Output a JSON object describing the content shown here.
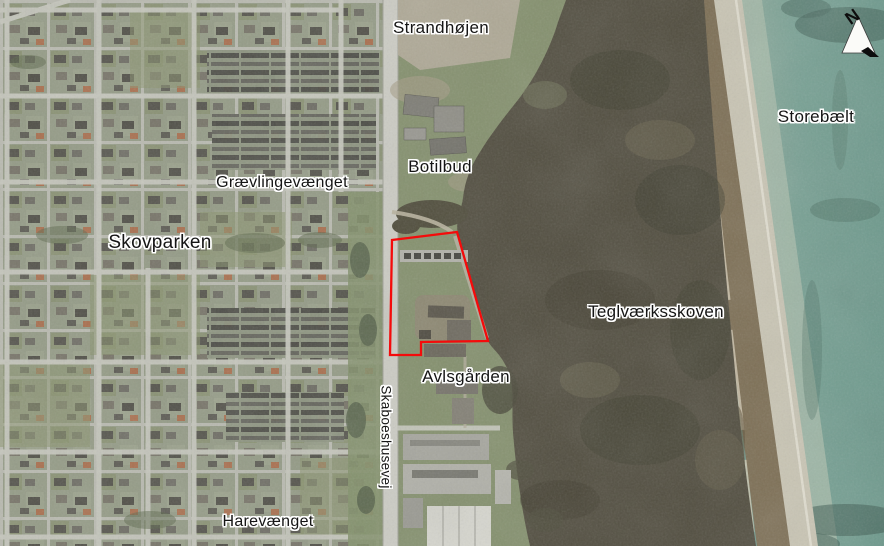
{
  "map": {
    "kind": "aerial-photo-map",
    "labels": {
      "strandhojen": "Strandhøjen",
      "storebaelt": "Storebælt",
      "botilbud": "Botilbud",
      "graevlingevaenget": "Grævlingevænget",
      "skovparken": "Skovparken",
      "teglvaerksskoven": "Teglværksskoven",
      "avlsgarden": "Avlsgården",
      "skaboeshusevej": "Skaboeshusevej",
      "harevaenget": "Harevænget"
    },
    "north_arrow": {
      "letter": "N"
    },
    "site_boundary": {
      "points": "392,240 457,232 488,341 421,342 421,355 390,355",
      "color": "#f40b0b"
    },
    "colors": {
      "sea": "#74998c",
      "shallow_water": "#a9bcab",
      "beach": "#c9c5b4",
      "cliff": "#7d6f55",
      "forest": "#514d3f",
      "field": "#84906d",
      "suburb": "#949b86",
      "road": "#ccccc4",
      "label_text": "#151515",
      "label_halo": "#ffffff"
    }
  }
}
